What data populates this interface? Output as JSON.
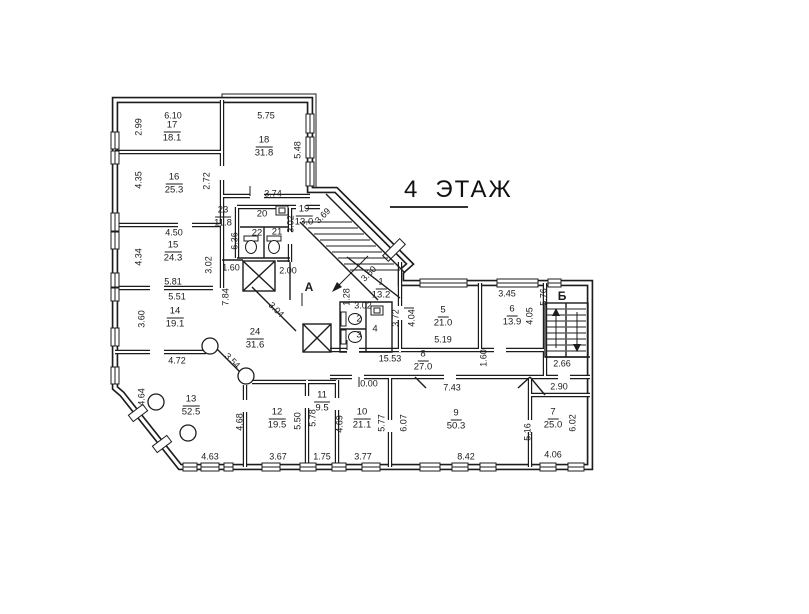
{
  "title": {
    "number": "4",
    "word": "ЭТАЖ"
  },
  "colors": {
    "ink": "#1b1b1b",
    "paper": "#ffffff"
  },
  "axes": [
    {
      "t": "А",
      "x": 309,
      "y": 287
    },
    {
      "t": "Б",
      "x": 562,
      "y": 296
    }
  ],
  "rooms": [
    {
      "n": "1",
      "a": "13.2",
      "x": 381,
      "y": 289
    },
    {
      "n": "2",
      "a": "",
      "x": 359,
      "y": 320
    },
    {
      "n": "3",
      "a": "",
      "x": 359,
      "y": 336
    },
    {
      "n": "4",
      "a": "",
      "x": 375,
      "y": 330
    },
    {
      "n": "5",
      "a": "21.0",
      "x": 443,
      "y": 317
    },
    {
      "n": "6",
      "a": "13.9",
      "x": 512,
      "y": 316
    },
    {
      "n": "7",
      "a": "25.0",
      "x": 553,
      "y": 419
    },
    {
      "n": "8",
      "a": "27.0",
      "x": 423,
      "y": 361
    },
    {
      "n": "9",
      "a": "50.3",
      "x": 456,
      "y": 420
    },
    {
      "n": "10",
      "a": "21.1",
      "x": 362,
      "y": 419
    },
    {
      "n": "11",
      "a": "9.5",
      "x": 322,
      "y": 402
    },
    {
      "n": "12",
      "a": "19.5",
      "x": 277,
      "y": 419
    },
    {
      "n": "13",
      "a": "52.5",
      "x": 191,
      "y": 406
    },
    {
      "n": "14",
      "a": "19.1",
      "x": 175,
      "y": 318
    },
    {
      "n": "15",
      "a": "24.3",
      "x": 173,
      "y": 252
    },
    {
      "n": "16",
      "a": "25.3",
      "x": 174,
      "y": 184
    },
    {
      "n": "17",
      "a": "18.1",
      "x": 172,
      "y": 132
    },
    {
      "n": "18",
      "a": "31.8",
      "x": 264,
      "y": 147
    },
    {
      "n": "19",
      "a": "13.0",
      "x": 304,
      "y": 216
    },
    {
      "n": "20",
      "a": "",
      "x": 262,
      "y": 215
    },
    {
      "n": "21",
      "a": "",
      "x": 277,
      "y": 233
    },
    {
      "n": "22",
      "a": "",
      "x": 257,
      "y": 234
    },
    {
      "n": "23",
      "a": "11.8",
      "x": 223,
      "y": 217
    },
    {
      "n": "24",
      "a": "31.6",
      "x": 255,
      "y": 339
    }
  ],
  "dims": [
    {
      "t": "6.10",
      "x": 173,
      "y": 116,
      "r": 0
    },
    {
      "t": "5.75",
      "x": 266,
      "y": 116,
      "r": 0
    },
    {
      "t": "3.74",
      "x": 273,
      "y": 194,
      "r": 0
    },
    {
      "t": "4.50",
      "x": 174,
      "y": 233,
      "r": 0
    },
    {
      "t": "5.81",
      "x": 173,
      "y": 282,
      "r": 0
    },
    {
      "t": "5.51",
      "x": 177,
      "y": 297,
      "r": 0
    },
    {
      "t": "1.60",
      "x": 231,
      "y": 268,
      "r": 0
    },
    {
      "t": "2.00",
      "x": 288,
      "y": 271,
      "r": 0
    },
    {
      "t": "4.72",
      "x": 177,
      "y": 361,
      "r": 0
    },
    {
      "t": "3.02",
      "x": 363,
      "y": 306,
      "r": 0
    },
    {
      "t": "5.19",
      "x": 443,
      "y": 340,
      "r": 0
    },
    {
      "t": "3.45",
      "x": 507,
      "y": 294,
      "r": 0
    },
    {
      "t": "15.53",
      "x": 390,
      "y": 359,
      "r": 0
    },
    {
      "t": "2.66",
      "x": 562,
      "y": 364,
      "r": 0
    },
    {
      "t": "0.00",
      "x": 369,
      "y": 384,
      "r": 0
    },
    {
      "t": "7.43",
      "x": 452,
      "y": 388,
      "r": 0
    },
    {
      "t": "2.90",
      "x": 559,
      "y": 387,
      "r": 0
    },
    {
      "t": "4.63",
      "x": 210,
      "y": 457,
      "r": 0
    },
    {
      "t": "3.67",
      "x": 278,
      "y": 457,
      "r": 0
    },
    {
      "t": "1.75",
      "x": 322,
      "y": 457,
      "r": 0
    },
    {
      "t": "3.77",
      "x": 363,
      "y": 457,
      "r": 0
    },
    {
      "t": "8.42",
      "x": 466,
      "y": 457,
      "r": 0
    },
    {
      "t": "4.06",
      "x": 553,
      "y": 455,
      "r": 0
    },
    {
      "t": "2.99",
      "x": 139,
      "y": 127,
      "r": -90
    },
    {
      "t": "4.35",
      "x": 139,
      "y": 180,
      "r": -90
    },
    {
      "t": "2.72",
      "x": 207,
      "y": 181,
      "r": -90
    },
    {
      "t": "5.48",
      "x": 298,
      "y": 150,
      "r": -90
    },
    {
      "t": "3.02",
      "x": 291,
      "y": 224,
      "r": -90
    },
    {
      "t": "6.36",
      "x": 235,
      "y": 241,
      "r": -90
    },
    {
      "t": "4.34",
      "x": 139,
      "y": 257,
      "r": -90
    },
    {
      "t": "3.02",
      "x": 209,
      "y": 265,
      "r": -90
    },
    {
      "t": "7.84",
      "x": 226,
      "y": 297,
      "r": -90
    },
    {
      "t": "3.60",
      "x": 142,
      "y": 319,
      "r": -90
    },
    {
      "t": "1.28",
      "x": 347,
      "y": 297,
      "r": -90
    },
    {
      "t": "3.72",
      "x": 396,
      "y": 318,
      "r": -90
    },
    {
      "t": "4.04",
      "x": 412,
      "y": 318,
      "r": -90
    },
    {
      "t": "4.05",
      "x": 530,
      "y": 316,
      "r": -90
    },
    {
      "t": "5.76",
      "x": 544,
      "y": 297,
      "r": -90
    },
    {
      "t": "1.60",
      "x": 484,
      "y": 358,
      "r": -90
    },
    {
      "t": "4.64",
      "x": 142,
      "y": 397,
      "r": -90
    },
    {
      "t": "4.68",
      "x": 240,
      "y": 422,
      "r": -90
    },
    {
      "t": "5.50",
      "x": 298,
      "y": 421,
      "r": -90
    },
    {
      "t": "5.78",
      "x": 313,
      "y": 418,
      "r": -90
    },
    {
      "t": "4.69",
      "x": 340,
      "y": 424,
      "r": -90
    },
    {
      "t": "5.77",
      "x": 382,
      "y": 423,
      "r": -90
    },
    {
      "t": "6.07",
      "x": 404,
      "y": 423,
      "r": -90
    },
    {
      "t": "5.16",
      "x": 528,
      "y": 432,
      "r": -90
    },
    {
      "t": "6.02",
      "x": 573,
      "y": 423,
      "r": -90
    },
    {
      "t": "3.69",
      "x": 323,
      "y": 216,
      "r": -45
    },
    {
      "t": "3.60",
      "x": 369,
      "y": 274,
      "r": -45
    },
    {
      "t": "3.04",
      "x": 276,
      "y": 310,
      "r": 45
    },
    {
      "t": "3.54",
      "x": 232,
      "y": 361,
      "r": 45
    }
  ]
}
